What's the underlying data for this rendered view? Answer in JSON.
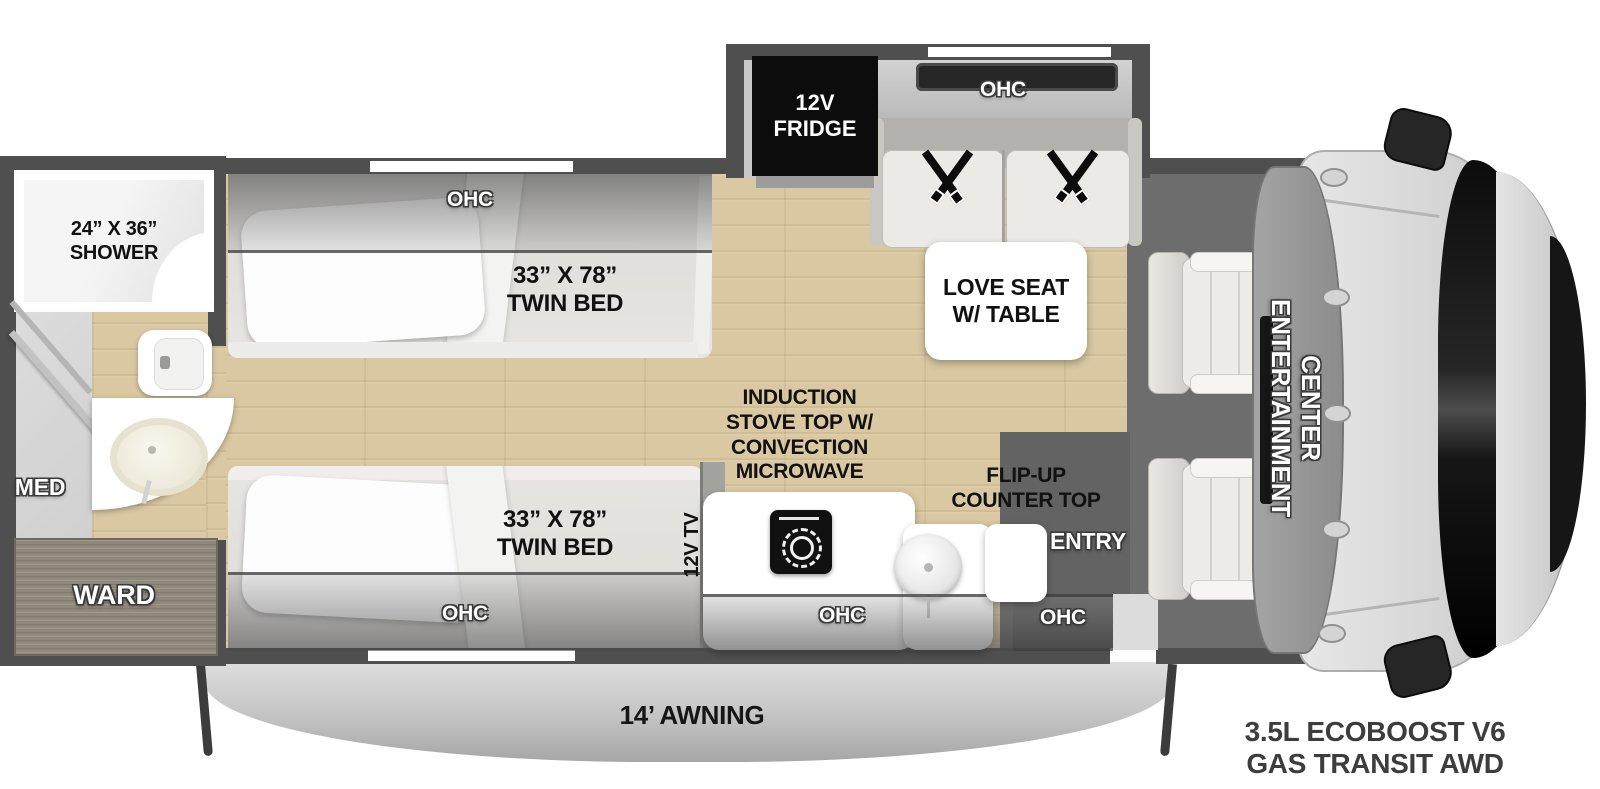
{
  "colors": {
    "wall": "#4f4f4f",
    "wood_floor": "#d9c8a2",
    "cab_floor": "#6d6d6d",
    "fridge_black": "#0c0c0c",
    "label_black": "#111111",
    "label_white": "#ffffff",
    "awning_gray": "#c3c3c3",
    "ward_wood": "#8f897c",
    "engine_text": "#3d3d3d"
  },
  "bathroom": {
    "shower_label": [
      "24” X 36”",
      "SHOWER"
    ],
    "med_label": "MED",
    "ward_label": "WARD"
  },
  "bedroom": {
    "ohc_top_label": "OHC",
    "ohc_bottom_label": "OHC",
    "bed_top_label": [
      "33” X 78”",
      "TWIN BED"
    ],
    "bed_bottom_label": [
      "33” X 78”",
      "TWIN BED"
    ],
    "tv_label": "12V TV"
  },
  "galley": {
    "stove_label": [
      "INDUCTION",
      "STOVE TOP W/",
      "CONVECTION",
      "MICROWAVE"
    ],
    "flip_up_label": [
      "FLIP-UP",
      "COUNTER TOP"
    ],
    "entry_label": "ENTRY",
    "ohc_label": "OHC",
    "entry_ohc_label": "OHC"
  },
  "slideout": {
    "fridge_label": [
      "12V",
      "FRIDGE"
    ],
    "ohc_label": "OHC",
    "loveseat_label": [
      "LOVE SEAT",
      "W/ TABLE"
    ]
  },
  "cab": {
    "entertainment_label": [
      "ENTERTAINMENT",
      "CENTER"
    ]
  },
  "footer": {
    "awning_label": "14’ AWNING",
    "engine_label": [
      "3.5L ECOBOOST V6",
      "GAS TRANSIT AWD"
    ]
  }
}
